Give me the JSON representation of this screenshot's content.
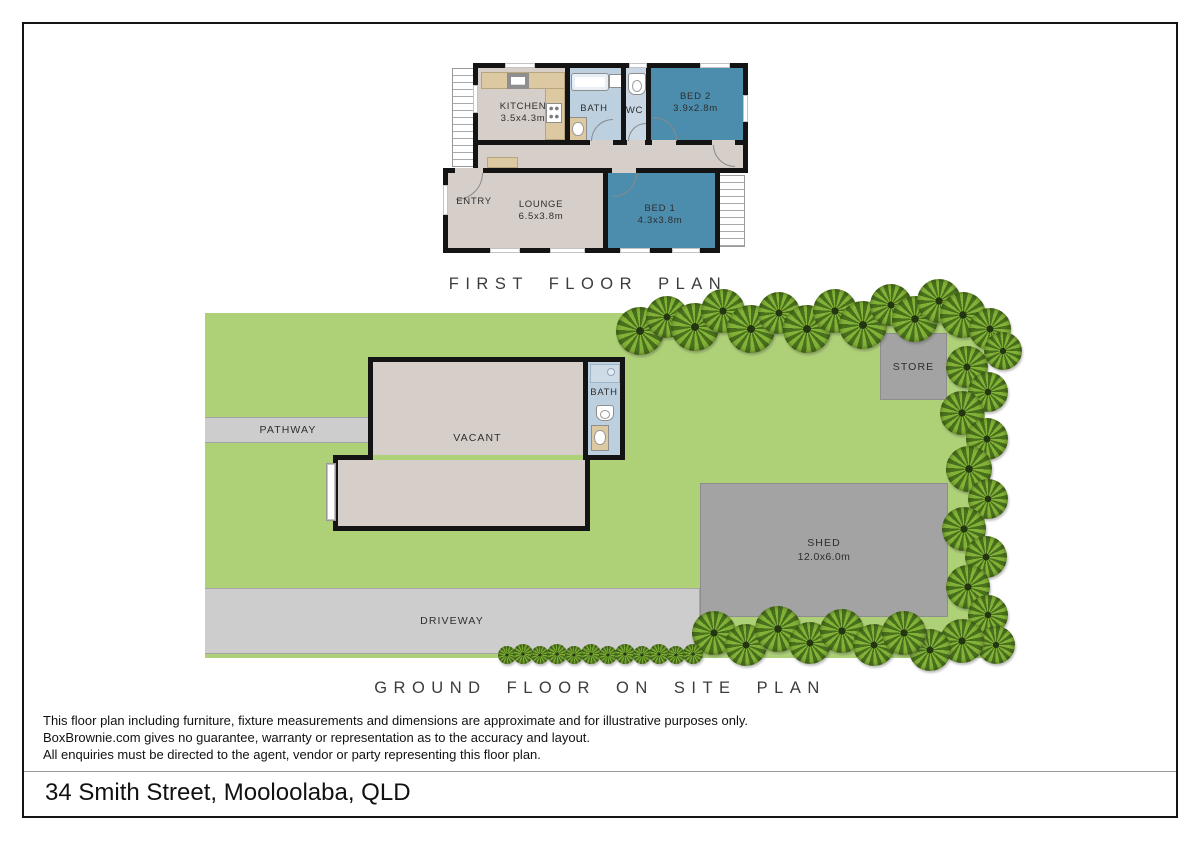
{
  "colors": {
    "wall": "#141414",
    "floor": "#d6cfc9",
    "bath": "#bdd0e0",
    "wc": "#c8d7e3",
    "bed": "#4c8cac",
    "counter": "#dcc9a2",
    "lawn": "#aed177",
    "concrete": "#cdcdcd",
    "shed": "#a3a3a3",
    "tree_dark": "#49701c",
    "tree_light": "#82b238"
  },
  "titles": {
    "first_floor": "FIRST FLOOR PLAN",
    "site": "GROUND FLOOR ON SITE PLAN"
  },
  "first_floor": {
    "kitchen_name": "KITCHEN",
    "kitchen_dims": "3.5x4.3m",
    "bath": "BATH",
    "wc": "WC",
    "bed2_name": "BED 2",
    "bed2_dims": "3.9x2.8m",
    "entry": "ENTRY",
    "lounge_name": "LOUNGE",
    "lounge_dims": "6.5x3.8m",
    "bed1_name": "BED 1",
    "bed1_dims": "4.3x3.8m"
  },
  "site_plan": {
    "pathway": "PATHWAY",
    "vacant": "VACANT",
    "bath": "BATH",
    "store": "STORE",
    "shed_name": "SHED",
    "shed_dims": "12.0x6.0m",
    "driveway": "DRIVEWAY",
    "trees": {
      "top": [
        [
          640,
          331,
          24
        ],
        [
          667,
          317,
          21
        ],
        [
          695,
          327,
          24
        ],
        [
          723,
          311,
          22
        ],
        [
          751,
          329,
          24
        ],
        [
          779,
          313,
          21
        ],
        [
          807,
          329,
          24
        ],
        [
          835,
          311,
          22
        ],
        [
          863,
          325,
          24
        ],
        [
          891,
          305,
          21
        ],
        [
          915,
          319,
          23
        ],
        [
          939,
          301,
          22
        ],
        [
          963,
          315,
          23
        ],
        [
          990,
          329,
          21
        ],
        [
          1003,
          351,
          19
        ]
      ],
      "right": [
        [
          967,
          367,
          21
        ],
        [
          988,
          392,
          20
        ],
        [
          962,
          413,
          22
        ],
        [
          987,
          439,
          21
        ],
        [
          969,
          469,
          23
        ],
        [
          988,
          499,
          20
        ],
        [
          964,
          529,
          22
        ],
        [
          986,
          557,
          21
        ],
        [
          968,
          587,
          22
        ],
        [
          988,
          615,
          20
        ],
        [
          996,
          645,
          19
        ],
        [
          962,
          641,
          22
        ],
        [
          930,
          650,
          21
        ]
      ],
      "bottom": [
        [
          714,
          633,
          22
        ],
        [
          746,
          645,
          21
        ],
        [
          778,
          629,
          23
        ],
        [
          810,
          643,
          21
        ],
        [
          842,
          631,
          22
        ],
        [
          874,
          645,
          21
        ],
        [
          904,
          633,
          22
        ]
      ],
      "hedge": [
        [
          507,
          655,
          9
        ],
        [
          523,
          654,
          10
        ],
        [
          540,
          655,
          9
        ],
        [
          557,
          654,
          10
        ],
        [
          574,
          655,
          9
        ],
        [
          591,
          654,
          10
        ],
        [
          608,
          655,
          9
        ],
        [
          625,
          654,
          10
        ],
        [
          642,
          655,
          9
        ],
        [
          659,
          654,
          10
        ],
        [
          676,
          655,
          9
        ],
        [
          693,
          654,
          10
        ]
      ]
    }
  },
  "footer": {
    "disclaimer": [
      "This floor plan including furniture, fixture measurements and dimensions are approximate and for illustrative purposes only.",
      "BoxBrownie.com gives no guarantee, warranty or representation as to the accuracy and layout.",
      "All enquiries must be directed to the agent, vendor or party representing this floor plan."
    ],
    "address": "34 Smith Street, Mooloolaba, QLD"
  }
}
